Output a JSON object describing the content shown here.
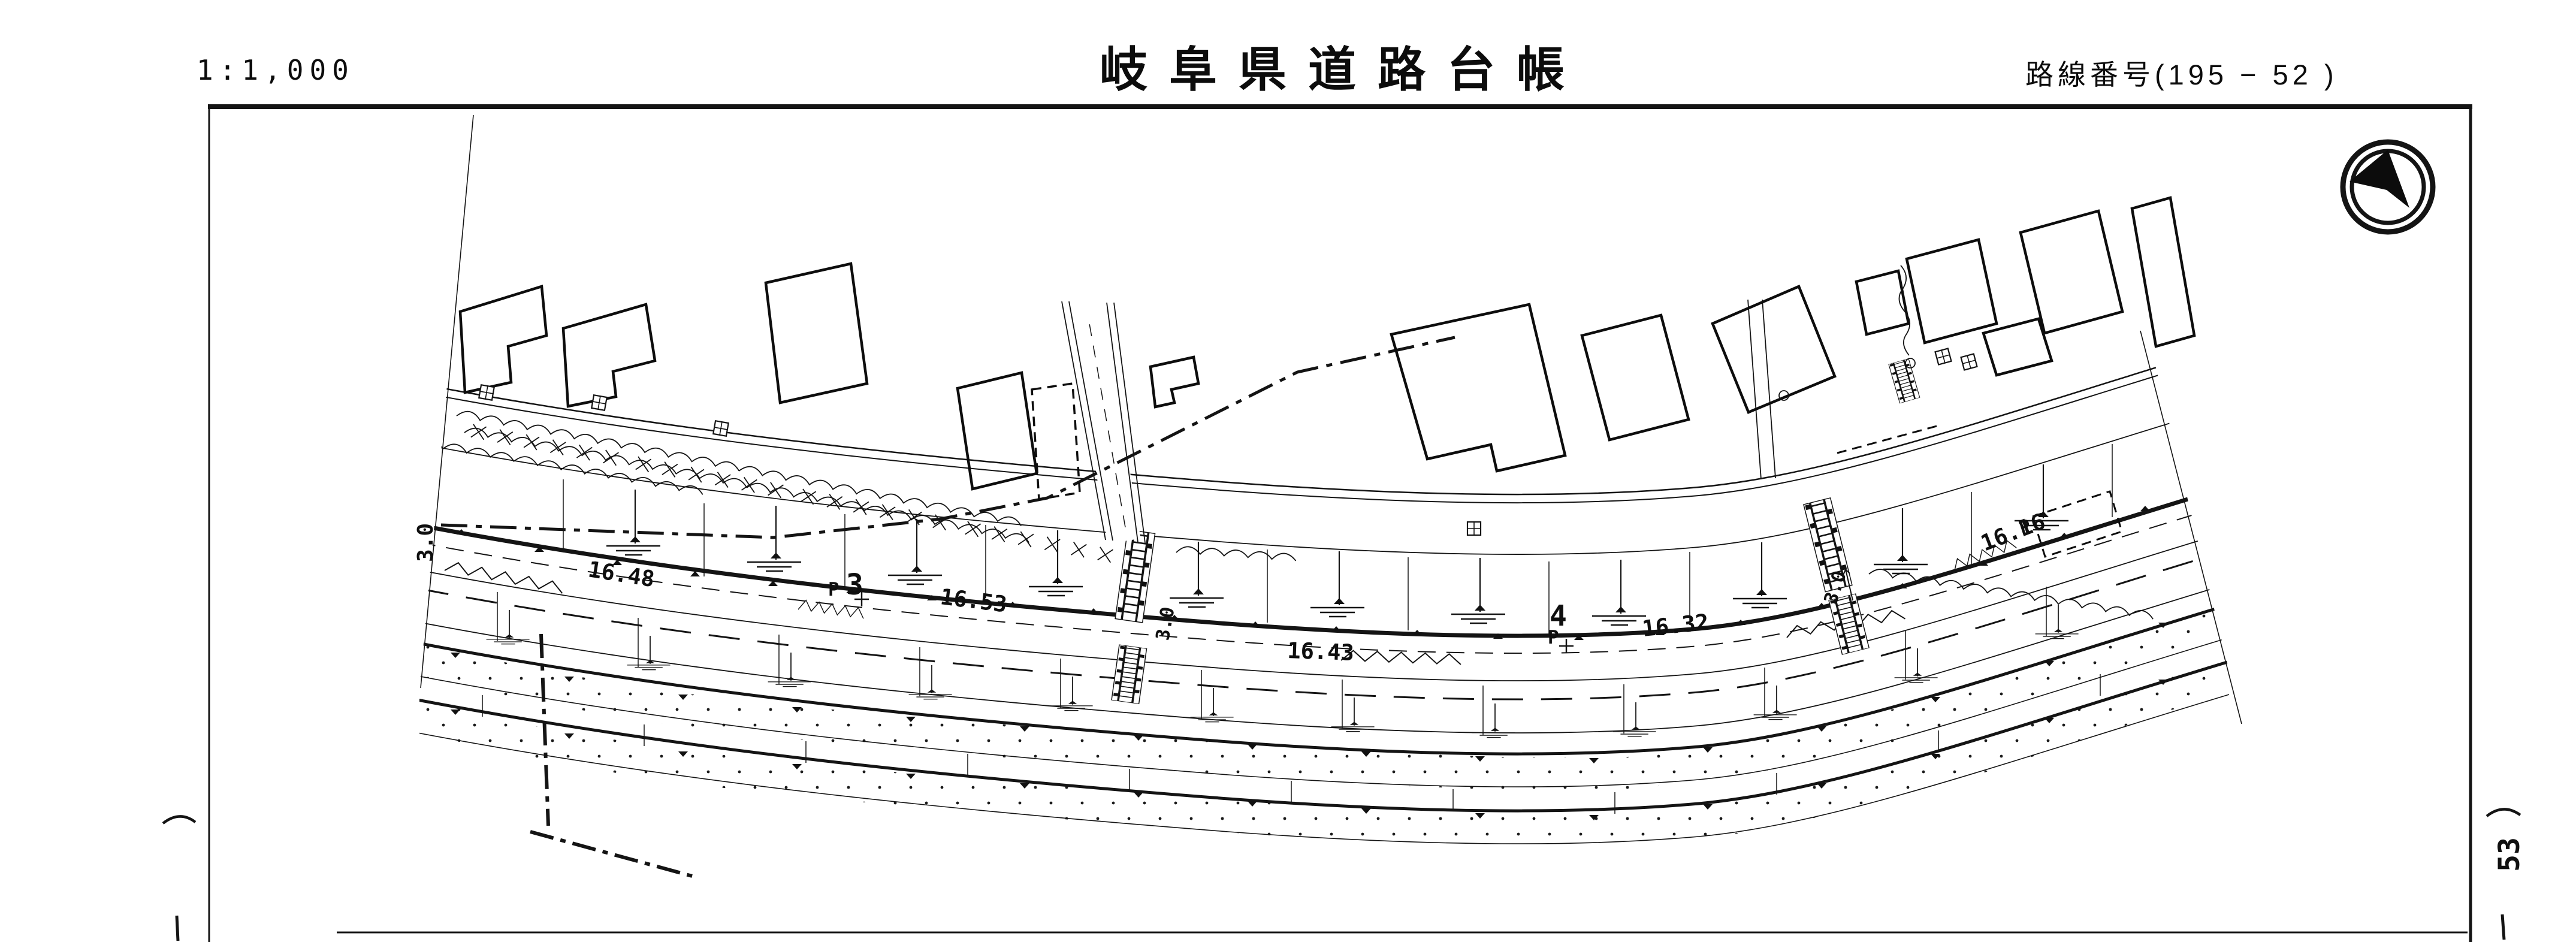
{
  "header": {
    "scale_label": "1:1,000",
    "title": "岐阜県道路台帳",
    "route_label": "路線番号(195 − 52 )"
  },
  "margin": {
    "next_sheet_number": "53"
  },
  "map": {
    "station_numbers": [
      "3",
      "4"
    ],
    "point_labels": [
      "P",
      "P",
      "P"
    ],
    "spot_elevations": [
      "16.48",
      "16.53",
      "16.43",
      "16.32",
      "16.16"
    ],
    "width_labels": [
      "3.0",
      "3.0",
      "3.0"
    ]
  }
}
